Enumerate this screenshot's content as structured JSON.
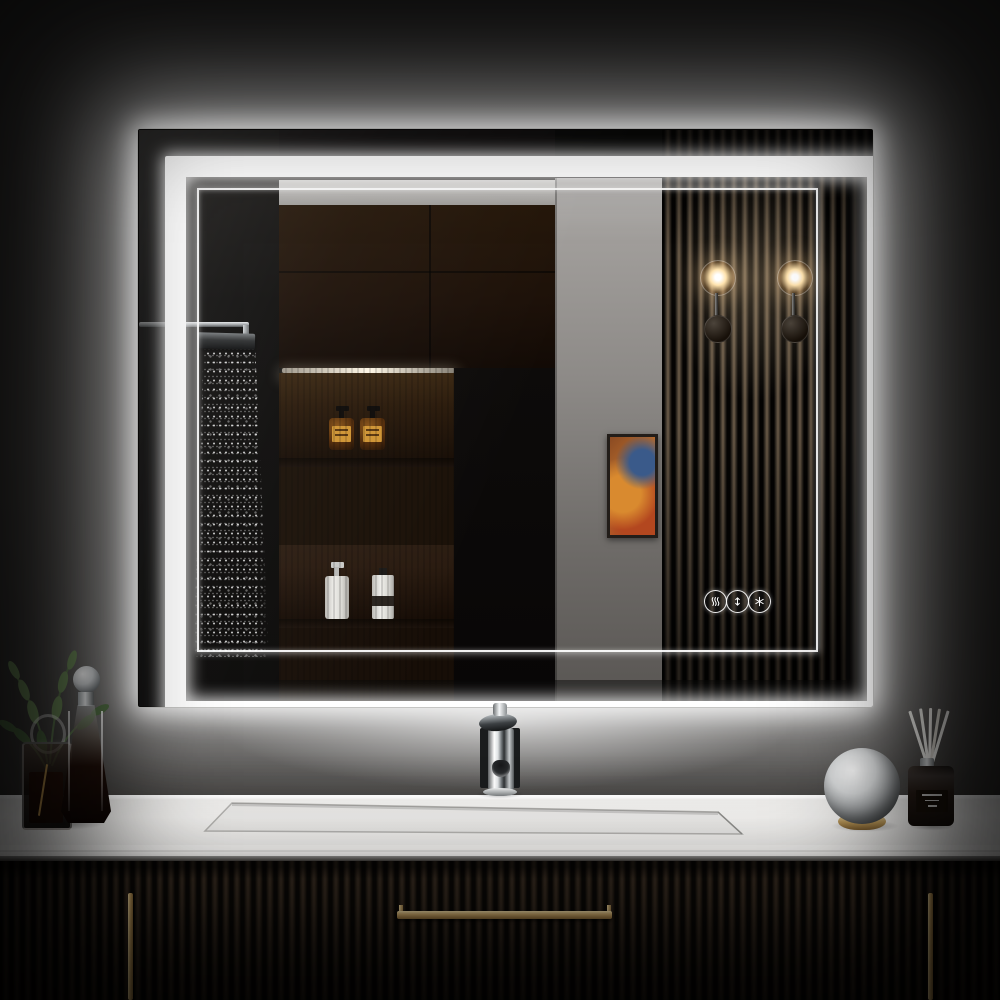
{
  "scene": {
    "title": "LED backlit bathroom vanity mirror product photo",
    "setting": "modern dark bathroom, mirror glowing over black fluted vanity"
  },
  "palette": {
    "wall": "#2b2a28",
    "glow": "#ffffff",
    "led": "#ffffff",
    "counter": "#f2f1ef",
    "cabinet": "#171310",
    "handle_gold": "#c9a566",
    "wood": "#22150b",
    "slat_mid": "#5f5142",
    "amber_label": "#cf9433",
    "art_orange": "#c97a33",
    "art_blue": "#3a5a8a",
    "leaf_green": "#6e8c5a",
    "chrome": "#d7dadc"
  },
  "mirror": {
    "buttons": [
      {
        "icon": "defogger-icon",
        "label": "Defogger"
      },
      {
        "icon": "brightness-icon",
        "label": "Dimmer"
      },
      {
        "icon": "color-temp-icon",
        "label": "Color temperature"
      }
    ]
  },
  "reflection": {
    "items": [
      "rain-shower-head",
      "water-spray",
      "towel-bar",
      "wood-shelf-cabinet",
      "amber-soap-bottles",
      "white-lotion-bottles",
      "dark-panel",
      "gray-wall",
      "abstract-artwork",
      "slat-wood-panel",
      "wall-sconce-left",
      "wall-sconce-right"
    ]
  },
  "vanity": {
    "items": [
      "green-plant-sprigs",
      "glass-cube-vase",
      "glass-ring",
      "glass-decanter",
      "red-glass-bottle",
      "chrome-faucet",
      "integrated-trough-sink",
      "mirrored-sphere-ornament",
      "reed-diffuser"
    ],
    "handles": [
      "left-vertical-pull",
      "center-horizontal-pull",
      "right-vertical-pull"
    ]
  }
}
